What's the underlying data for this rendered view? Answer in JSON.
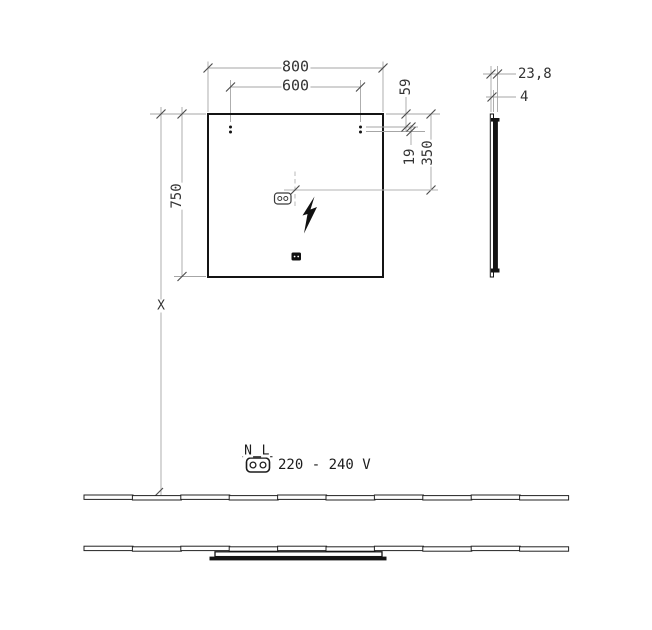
{
  "drawing": {
    "title_hint": "mirror-installation-drawing",
    "colors": {
      "object_line": "#141414",
      "dimension_line": "#a6a6a6",
      "tick": "#4d4d4d",
      "text": "#333333"
    },
    "icons": {
      "outlet_front": "two-pin-connector-icon",
      "power": "lightning-bolt-icon",
      "sensor": "sensor-switch-icon",
      "mains_plug": "two-pin-connector-icon"
    },
    "labels": {
      "width_outer": "800",
      "width_holes": "600",
      "height": "750",
      "top_to_hole": "59",
      "hole_gap": "19",
      "top_to_outlet": "350",
      "mount_height": "X",
      "depth_total": "23,8",
      "glass_thickness": "4",
      "terminal_n": "N",
      "terminal_l": "L",
      "voltage": "220 - 240 V"
    }
  }
}
